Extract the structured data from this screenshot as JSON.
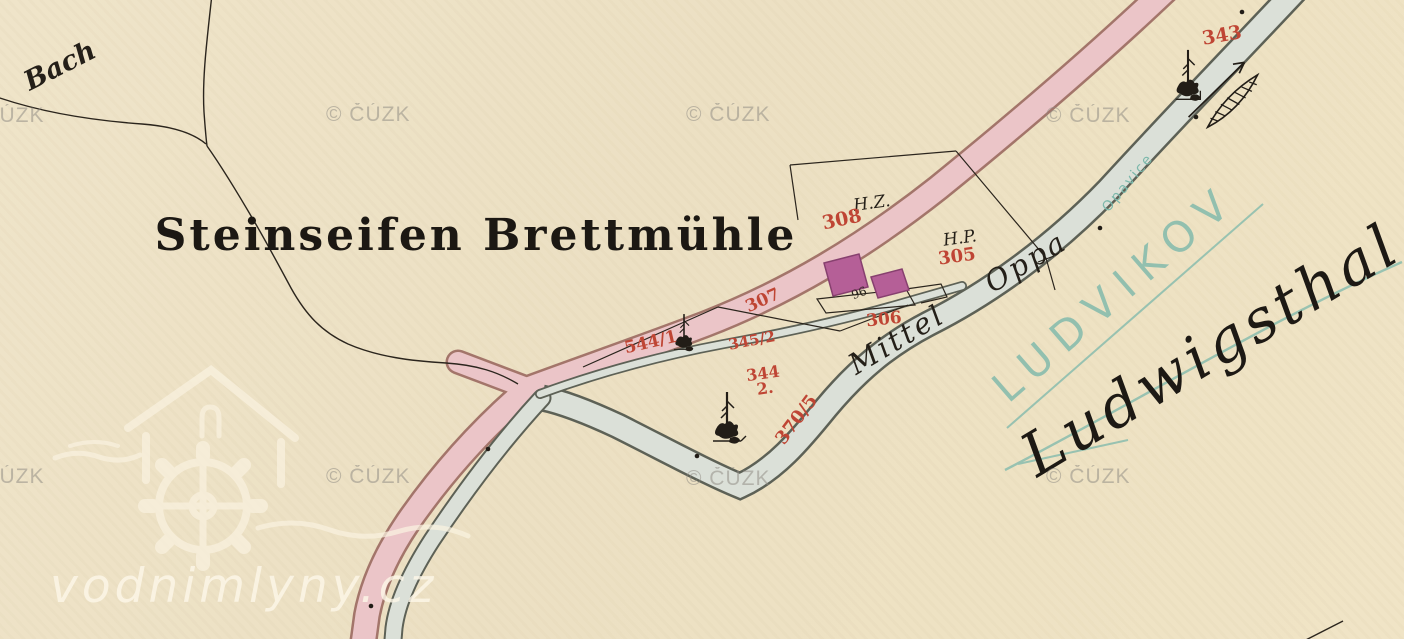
{
  "map": {
    "title": "Steinseifen Brettmühle",
    "hydro_labels": {
      "bach": "Bach",
      "river_german": "Mittel Oppa",
      "river_czech": "Opavice",
      "water_parcel": "370/5"
    },
    "settlement_names": {
      "czech": "LUDVIKOV",
      "german": "Ludwigsthal"
    },
    "culture_labels": {
      "hz": "H.Z.",
      "hp": "H.P."
    },
    "parcel_numbers": {
      "p308": "308",
      "p305": "305",
      "p306": "306",
      "p307": "307",
      "p343": "343",
      "p344_2_line1": "344",
      "p344_2_line2": "2.",
      "p345_2": "345/2",
      "p544_1": "544/1"
    },
    "house_number": "96",
    "icons": {
      "tree": "tree-icon",
      "weir_arrow": "weir-icon",
      "watermill_logo": "watermill-logo-icon"
    },
    "colors": {
      "paper": "#ece0c5",
      "road_fill": "#ebc5c8",
      "road_edge": "#a3756a",
      "water_fill": "#dbe0d8",
      "water_edge": "#5d6156",
      "building_fill": "#b55f97",
      "building_edge": "#87406f",
      "parcel_number_red": "#bf4534",
      "teal_names": "#7cb8ab",
      "ink_black": "#241f18",
      "watermark_gray": "#8f8b83"
    }
  },
  "watermarks": {
    "cuzk": "© ČÚZK",
    "site": "vodnimlyny.cz"
  }
}
